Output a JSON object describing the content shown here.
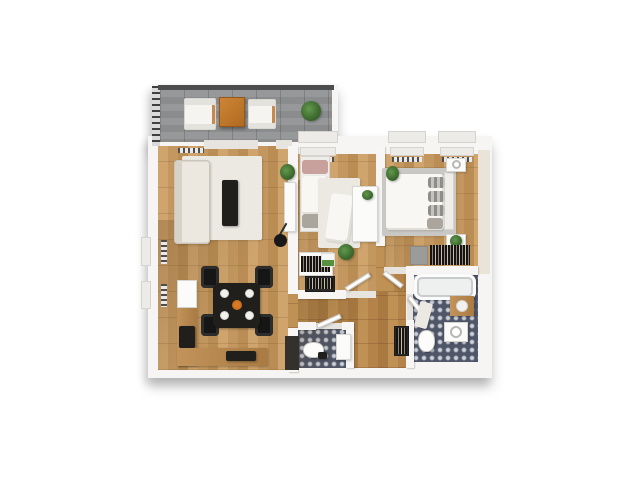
{
  "scene": {
    "description": "3D top-down render of a two-bedroom apartment floor plan on white background",
    "background": "#ffffff",
    "colors": {
      "wall": "#f6f5f3",
      "wood_floor": "#c3975f",
      "hall_wood_floor": "#b3834a",
      "balcony_deck": "#8f9193",
      "bathroom_tile": "#4e5668",
      "tile_pattern": "#ccd1d9",
      "rug_light": "#ece9e2",
      "rug_gray": "#c9c8c4",
      "sofa_cream": "#ece8e0",
      "furniture_dark": "#211f1c",
      "accent_orange": "#c1762e",
      "plant_green": "#3c6a2e",
      "pillow_pink": "#c8a09c"
    }
  },
  "plan": {
    "items": [
      {
        "n": "balcony-slab",
        "c": "wall",
        "x": 152,
        "y": 84,
        "w": 186,
        "h": 64
      },
      {
        "n": "apartment-slab",
        "c": "wall",
        "x": 148,
        "y": 136,
        "w": 344,
        "h": 242
      },
      {
        "n": "balcony-deck-floor",
        "c": "floor-deck",
        "x": 160,
        "y": 90,
        "w": 172,
        "h": 52
      },
      {
        "n": "balcony-railing-left",
        "c": "railing-v",
        "x": 152,
        "y": 86,
        "w": 8,
        "h": 60
      },
      {
        "n": "balcony-railing-top",
        "c": "railing-h",
        "x": 158,
        "y": 85,
        "w": 176,
        "h": 5
      },
      {
        "n": "balcony-lounger-1",
        "c": "lounger",
        "x": 184,
        "y": 98,
        "w": 32,
        "h": 32
      },
      {
        "n": "balcony-table",
        "c": "orange-table",
        "x": 219,
        "y": 97,
        "w": 26,
        "h": 30
      },
      {
        "n": "balcony-lounger-2",
        "c": "lounger",
        "x": 248,
        "y": 99,
        "w": 28,
        "h": 30
      },
      {
        "n": "balcony-plant",
        "c": "plant",
        "x": 301,
        "y": 101,
        "w": 20,
        "h": 20
      },
      {
        "n": "living-room-floor",
        "c": "floor-wood",
        "x": 158,
        "y": 146,
        "w": 132,
        "h": 224
      },
      {
        "n": "bedroom2-floor",
        "c": "floor-wood",
        "x": 298,
        "y": 154,
        "w": 80,
        "h": 138
      },
      {
        "n": "master-bedroom-floor",
        "c": "floor-wood",
        "x": 384,
        "y": 154,
        "w": 94,
        "h": 118
      },
      {
        "n": "hallway-floor",
        "c": "floor-wood-dark",
        "x": 298,
        "y": 292,
        "w": 108,
        "h": 76
      },
      {
        "n": "hallway-corridor-floor",
        "c": "floor-wood-dark",
        "x": 376,
        "y": 244,
        "w": 10,
        "h": 48
      },
      {
        "n": "hallway-nook-floor",
        "c": "floor-wood-dark",
        "x": 384,
        "y": 272,
        "w": 22,
        "h": 20
      },
      {
        "n": "bathroom-floor",
        "c": "floor-tile",
        "x": 412,
        "y": 274,
        "w": 66,
        "h": 88
      },
      {
        "n": "wc-floor",
        "c": "floor-tile",
        "x": 298,
        "y": 328,
        "w": 54,
        "h": 40
      },
      {
        "n": "living-room-light-shadow",
        "c": "soft-shadow",
        "x": 158,
        "y": 220,
        "w": 132,
        "h": 150
      },
      {
        "n": "bedroom2-light-shadow",
        "c": "soft-shadow",
        "x": 298,
        "y": 180,
        "w": 80,
        "h": 112
      },
      {
        "n": "master-light-shadow",
        "c": "soft-shadow",
        "x": 384,
        "y": 170,
        "w": 94,
        "h": 100
      },
      {
        "n": "hallway-light-shadow",
        "c": "soft-shadow",
        "x": 298,
        "y": 292,
        "w": 108,
        "h": 76
      },
      {
        "n": "balcony-sliding-door-threshold",
        "c": "threshold",
        "x": 204,
        "y": 140,
        "w": 54,
        "h": 9
      },
      {
        "n": "living-window-threshold",
        "c": "threshold",
        "x": 276,
        "y": 140,
        "w": 16,
        "h": 9
      },
      {
        "n": "living-top-radiator",
        "c": "radiator",
        "x": 178,
        "y": 148,
        "w": 26,
        "h": 5
      },
      {
        "n": "bedroom2-window-sill",
        "c": "sill",
        "x": 298,
        "y": 131,
        "w": 40,
        "h": 12
      },
      {
        "n": "bedroom2-window-bench",
        "c": "sill",
        "x": 300,
        "y": 147,
        "w": 36,
        "h": 9
      },
      {
        "n": "bedroom2-radiator",
        "c": "radiator",
        "x": 302,
        "y": 157,
        "w": 32,
        "h": 5
      },
      {
        "n": "master-window1-sill",
        "c": "sill",
        "x": 388,
        "y": 131,
        "w": 38,
        "h": 12
      },
      {
        "n": "master-window1-bench",
        "c": "sill",
        "x": 390,
        "y": 147,
        "w": 34,
        "h": 9
      },
      {
        "n": "master-radiator1",
        "c": "radiator",
        "x": 392,
        "y": 157,
        "w": 30,
        "h": 5
      },
      {
        "n": "master-window2-sill",
        "c": "sill",
        "x": 438,
        "y": 131,
        "w": 38,
        "h": 12
      },
      {
        "n": "master-window2-bench",
        "c": "sill",
        "x": 440,
        "y": 147,
        "w": 34,
        "h": 9
      },
      {
        "n": "master-radiator2",
        "c": "radiator",
        "x": 442,
        "y": 157,
        "w": 30,
        "h": 5
      },
      {
        "n": "left-window1-sill",
        "c": "sill",
        "x": 141,
        "y": 237,
        "w": 10,
        "h": 29
      },
      {
        "n": "left-radiator1",
        "c": "radiator-v",
        "x": 161,
        "y": 240,
        "w": 6,
        "h": 24
      },
      {
        "n": "left-window2-sill",
        "c": "sill",
        "x": 141,
        "y": 281,
        "w": 10,
        "h": 28
      },
      {
        "n": "left-radiator2",
        "c": "radiator-v",
        "x": 161,
        "y": 284,
        "w": 6,
        "h": 23
      },
      {
        "n": "right-wall-accent",
        "c": "beige",
        "x": 478,
        "y": 150,
        "w": 12,
        "h": 124
      },
      {
        "n": "wall-living-bedroom2",
        "c": "wall-in",
        "x": 288,
        "y": 146,
        "w": 10,
        "h": 148
      },
      {
        "n": "living-hall-opening",
        "c": "floor-wood-dark",
        "x": 288,
        "y": 294,
        "w": 10,
        "h": 34
      },
      {
        "n": "wall-living-wc",
        "c": "wall-in",
        "x": 288,
        "y": 328,
        "w": 10,
        "h": 44
      },
      {
        "n": "entry-door",
        "c": "dark-door",
        "x": 285,
        "y": 336,
        "w": 14,
        "h": 34
      },
      {
        "n": "wall-bedroom2-bottom",
        "c": "wall-in",
        "x": 298,
        "y": 290,
        "w": 48,
        "h": 9
      },
      {
        "n": "wall-bedroom2-master",
        "c": "wall-in",
        "x": 376,
        "y": 146,
        "w": 9,
        "h": 100
      },
      {
        "n": "wall-master-bottom",
        "c": "wall-in",
        "x": 406,
        "y": 266,
        "w": 72,
        "h": 9
      },
      {
        "n": "wall-hall-bath-upper",
        "c": "wall-in",
        "x": 406,
        "y": 274,
        "w": 8,
        "h": 20
      },
      {
        "n": "wall-hall-bath-lower",
        "c": "wall-in",
        "x": 406,
        "y": 320,
        "w": 8,
        "h": 48
      },
      {
        "n": "wall-wc-top-left",
        "c": "wall-in",
        "x": 298,
        "y": 322,
        "w": 18,
        "h": 8
      },
      {
        "n": "wall-wc-top-right",
        "c": "wall-in",
        "x": 342,
        "y": 322,
        "w": 12,
        "h": 8
      },
      {
        "n": "wall-wc-right",
        "c": "wall-in",
        "x": 346,
        "y": 328,
        "w": 8,
        "h": 40
      },
      {
        "n": "bedroom2-door-threshold",
        "c": "threshold",
        "x": 346,
        "y": 291,
        "w": 30,
        "h": 7
      },
      {
        "n": "master-door-threshold",
        "c": "threshold",
        "x": 384,
        "y": 267,
        "w": 22,
        "h": 7
      },
      {
        "n": "bath-door-threshold",
        "c": "threshold",
        "x": 407,
        "y": 294,
        "w": 6,
        "h": 26
      },
      {
        "n": "wc-door-threshold",
        "c": "threshold",
        "x": 316,
        "y": 323,
        "w": 26,
        "h": 6
      },
      {
        "n": "bedroom2-door",
        "c": "door-panel",
        "x": 346,
        "y": 287,
        "w": 28,
        "h": 5,
        "rot": -32
      },
      {
        "n": "master-door",
        "c": "door-panel",
        "x": 384,
        "y": 270,
        "w": 23,
        "h": 5,
        "rot": 38
      },
      {
        "n": "bathroom-door",
        "c": "door-panel",
        "x": 409,
        "y": 294,
        "w": 25,
        "h": 5,
        "rot": 52
      },
      {
        "n": "wc-door",
        "c": "door-panel",
        "x": 317,
        "y": 324,
        "w": 26,
        "h": 5,
        "rot": -24
      },
      {
        "n": "living-rug",
        "c": "rug-light",
        "x": 182,
        "y": 156,
        "w": 80,
        "h": 84
      },
      {
        "n": "sofa",
        "c": "sofa",
        "x": 174,
        "y": 160,
        "w": 36,
        "h": 84
      },
      {
        "n": "tv-console",
        "c": "dark-furn",
        "x": 222,
        "y": 180,
        "w": 16,
        "h": 46
      },
      {
        "n": "living-shelf",
        "c": "white-furn",
        "x": 284,
        "y": 182,
        "w": 12,
        "h": 50
      },
      {
        "n": "living-plant",
        "c": "plant",
        "x": 280,
        "y": 164,
        "w": 15,
        "h": 16
      },
      {
        "n": "floor-lamp-arm",
        "c": "lamp-arm",
        "x": 281,
        "y": 222,
        "w": 2,
        "h": 18,
        "rot": 30
      },
      {
        "n": "floor-lamp-head",
        "c": "lamp-dot",
        "x": 274,
        "y": 234,
        "w": 13,
        "h": 13
      },
      {
        "n": "dining-chair-top-left",
        "c": "chair",
        "x": 201,
        "y": 266,
        "w": 18,
        "h": 22
      },
      {
        "n": "dining-chair-top-right",
        "c": "chair",
        "x": 255,
        "y": 266,
        "w": 18,
        "h": 22
      },
      {
        "n": "dining-chair-bottom-left",
        "c": "chair",
        "x": 201,
        "y": 314,
        "w": 18,
        "h": 22
      },
      {
        "n": "dining-chair-bottom-right",
        "c": "chair",
        "x": 255,
        "y": 314,
        "w": 18,
        "h": 22
      },
      {
        "n": "dining-table",
        "c": "dark-furn",
        "x": 213,
        "y": 283,
        "w": 47,
        "h": 45,
        "r": 6
      },
      {
        "n": "plate-1",
        "c": "plate",
        "x": 220,
        "y": 289,
        "w": 9,
        "h": 9
      },
      {
        "n": "plate-2",
        "c": "plate",
        "x": 245,
        "y": 289,
        "w": 9,
        "h": 9
      },
      {
        "n": "plate-3",
        "c": "plate",
        "x": 220,
        "y": 311,
        "w": 9,
        "h": 9
      },
      {
        "n": "plate-4",
        "c": "plate",
        "x": 245,
        "y": 311,
        "w": 9,
        "h": 9
      },
      {
        "n": "fruit-bowl",
        "c": "bowl",
        "x": 232,
        "y": 300,
        "w": 10,
        "h": 10
      },
      {
        "n": "kitchen-cabinet",
        "c": "white-furn",
        "x": 177,
        "y": 280,
        "w": 20,
        "h": 28
      },
      {
        "n": "kitchen-counter-left",
        "c": "wood-furn",
        "x": 177,
        "y": 308,
        "w": 20,
        "h": 58
      },
      {
        "n": "kitchen-oven",
        "c": "dark-furn",
        "x": 179,
        "y": 326,
        "w": 16,
        "h": 22
      },
      {
        "n": "kitchen-counter-bottom",
        "c": "wood-furn",
        "x": 177,
        "y": 348,
        "w": 90,
        "h": 18
      },
      {
        "n": "kitchen-sink",
        "c": "dark-furn",
        "x": 226,
        "y": 351,
        "w": 30,
        "h": 10
      },
      {
        "n": "bedroom2-bed-frame",
        "c": "bed-frame",
        "x": 300,
        "y": 156,
        "w": 30,
        "h": 76
      },
      {
        "n": "bedroom2-pillow-pink",
        "c": "pillow-pink",
        "x": 302,
        "y": 160,
        "w": 26,
        "h": 14
      },
      {
        "n": "bedroom2-duvet",
        "c": "duvet",
        "x": 302,
        "y": 176,
        "w": 26,
        "h": 38
      },
      {
        "n": "bedroom2-pillow-gray",
        "c": "pillow-gray",
        "x": 302,
        "y": 214,
        "w": 24,
        "h": 14
      },
      {
        "n": "bedroom2-rug",
        "c": "rug-light",
        "x": 318,
        "y": 178,
        "w": 42,
        "h": 70
      },
      {
        "n": "bedroom2-throw-blanket",
        "c": "duvet",
        "x": 328,
        "y": 194,
        "w": 24,
        "h": 48,
        "rot": 8
      },
      {
        "n": "bedroom2-desk",
        "c": "white-furn",
        "x": 352,
        "y": 186,
        "w": 26,
        "h": 56
      },
      {
        "n": "desk-plant",
        "c": "plant",
        "x": 362,
        "y": 190,
        "w": 11,
        "h": 10
      },
      {
        "n": "bedroom2-floor-plant",
        "c": "plant",
        "x": 338,
        "y": 244,
        "w": 16,
        "h": 16
      },
      {
        "n": "bedroom2-bookshelf",
        "c": "white-furn",
        "x": 299,
        "y": 252,
        "w": 34,
        "h": 24
      },
      {
        "n": "bedroom2-books",
        "c": "books",
        "x": 301,
        "y": 256,
        "w": 29,
        "h": 16
      },
      {
        "n": "bedroom2-bookshelf2",
        "c": "dark-shelf",
        "x": 305,
        "y": 276,
        "w": 30,
        "h": 16
      },
      {
        "n": "bedroom2-books2",
        "c": "books",
        "x": 307,
        "y": 278,
        "w": 26,
        "h": 11
      },
      {
        "n": "bedroom2-poster",
        "c": "poster",
        "x": 321,
        "y": 253,
        "w": 14,
        "h": 14
      },
      {
        "n": "master-rug",
        "c": "rug-gray",
        "x": 382,
        "y": 168,
        "w": 74,
        "h": 68
      },
      {
        "n": "master-bed-duvet",
        "c": "duvet",
        "x": 386,
        "y": 174,
        "w": 58,
        "h": 56
      },
      {
        "n": "master-headboard",
        "c": "bed-frame",
        "x": 444,
        "y": 172,
        "w": 10,
        "h": 58
      },
      {
        "n": "master-pillow1",
        "c": "pillow-pattern",
        "x": 428,
        "y": 177,
        "w": 17,
        "h": 11
      },
      {
        "n": "master-pillow2",
        "c": "pillow-pattern",
        "x": 428,
        "y": 191,
        "w": 17,
        "h": 11
      },
      {
        "n": "master-pillow3",
        "c": "pillow-pattern",
        "x": 428,
        "y": 205,
        "w": 17,
        "h": 11
      },
      {
        "n": "master-pillow4",
        "c": "pillow-gray",
        "x": 427,
        "y": 218,
        "w": 16,
        "h": 11
      },
      {
        "n": "nightstand-top",
        "c": "white-furn",
        "x": 446,
        "y": 158,
        "w": 20,
        "h": 14
      },
      {
        "n": "nightstand-decor",
        "c": "decor-dot",
        "x": 452,
        "y": 160,
        "w": 9,
        "h": 9
      },
      {
        "n": "nightstand-bottom",
        "c": "white-furn",
        "x": 446,
        "y": 234,
        "w": 20,
        "h": 14
      },
      {
        "n": "nightstand-plant",
        "c": "plant",
        "x": 450,
        "y": 235,
        "w": 12,
        "h": 12
      },
      {
        "n": "master-corner-plant",
        "c": "plant",
        "x": 386,
        "y": 166,
        "w": 13,
        "h": 15
      },
      {
        "n": "wardrobe-box",
        "c": "gray-furn",
        "x": 410,
        "y": 246,
        "w": 18,
        "h": 19
      },
      {
        "n": "wardrobe-clothes-rail",
        "c": "books",
        "x": 430,
        "y": 245,
        "w": 40,
        "h": 20
      },
      {
        "n": "bathtub",
        "c": "tub",
        "x": 414,
        "y": 274,
        "w": 62,
        "h": 26
      },
      {
        "n": "bathroom-vanity",
        "c": "wood-furn",
        "x": 450,
        "y": 296,
        "w": 24,
        "h": 20
      },
      {
        "n": "bathroom-sink",
        "c": "plate",
        "x": 456,
        "y": 300,
        "w": 12,
        "h": 12
      },
      {
        "n": "washing-machine",
        "c": "white-furn",
        "x": 444,
        "y": 322,
        "w": 24,
        "h": 20
      },
      {
        "n": "washing-machine-door",
        "c": "decor-dot",
        "x": 450,
        "y": 326,
        "w": 12,
        "h": 12
      },
      {
        "n": "bathroom-toilet",
        "c": "toilet",
        "x": 418,
        "y": 330,
        "w": 15,
        "h": 20
      },
      {
        "n": "bath-mat",
        "c": "rug-light",
        "x": 417,
        "y": 302,
        "w": 13,
        "h": 26,
        "rot": 15
      },
      {
        "n": "hallway-rack",
        "c": "dark-shelf",
        "x": 394,
        "y": 326,
        "w": 15,
        "h": 30
      },
      {
        "n": "hallway-rack-items",
        "c": "books",
        "x": 396,
        "y": 328,
        "w": 11,
        "h": 26
      },
      {
        "n": "wc-toilet",
        "c": "toilet",
        "x": 303,
        "y": 342,
        "w": 19,
        "h": 14
      },
      {
        "n": "wc-vanity",
        "c": "white-furn",
        "x": 336,
        "y": 334,
        "w": 15,
        "h": 26
      },
      {
        "n": "wc-floor-item",
        "c": "dark-furn",
        "x": 318,
        "y": 352,
        "w": 9,
        "h": 7
      }
    ]
  }
}
